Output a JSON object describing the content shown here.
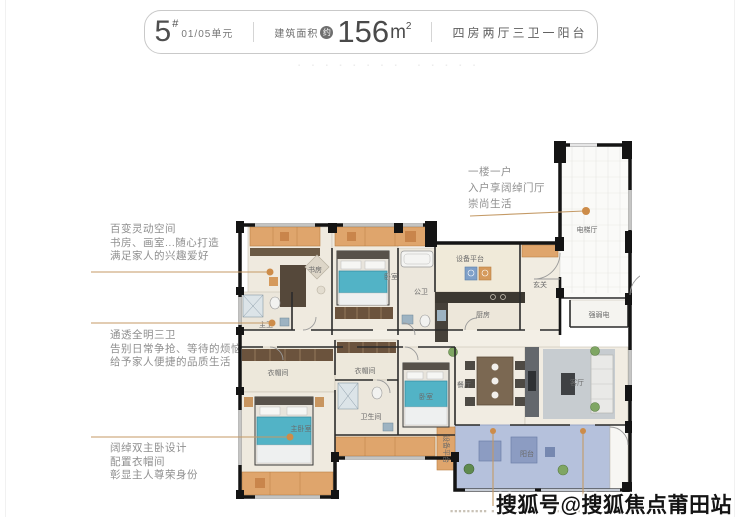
{
  "header": {
    "building_number": "5",
    "building_sup": "#",
    "unit": "01/05单元",
    "area_label": "建筑面积",
    "area_approx": "约",
    "area_value": "156",
    "area_unit": "m",
    "area_exponent": "2",
    "layout_desc": "四房两厅三卫一阳台"
  },
  "decor": {
    "faint_row_left": "▪ ▪ ▪ ▪ ▪ ▪ ▪ ▪",
    "faint_row_right": "▪ ▪ ▪ ▪ ▪",
    "bottom_fragment_left": "▪▪▪▪▪▪▪▪▪ ▪",
    "bottom_fragment_right": "▪▪▪▪▪▪▪"
  },
  "annotations": {
    "left": [
      {
        "lines": [
          "百变灵动空间",
          "书房、画室...随心打造",
          "满足家人的兴趣爱好"
        ]
      },
      {
        "lines": [
          "通透全明三卫",
          "告别日常争抢、等待的烦恼",
          "给予家人便捷的品质生活"
        ]
      },
      {
        "lines": [
          "阔绰双主卧设计",
          "配置衣帽间",
          "彰显主人尊荣身份"
        ]
      }
    ],
    "right": {
      "lines": [
        "一楼一户",
        "入户享阔绰门厅",
        "崇尚生活"
      ]
    }
  },
  "floorplan": {
    "rooms": {
      "elevator_hall": "电梯厅",
      "equipment_platform_top": "设备平台",
      "foyer": "玄关",
      "utility": "强弱电",
      "kitchen": "厨房",
      "public_bath": "公卫",
      "study": "书房",
      "bedroom_top": "卧室",
      "master_bath": "主卫",
      "closet_left": "衣帽间",
      "closet_mid": "衣帽间",
      "bathroom": "卫生间",
      "bedroom_right": "卧室",
      "master_bedroom": "主卧室",
      "dining": "餐厅",
      "living": "客厅",
      "balcony": "阳台",
      "equipment_platform_bottom": "设备平台"
    }
  },
  "watermark": {
    "text": "搜狐号@搜狐焦点莆田站"
  },
  "colors": {
    "callout_line": "#c49a66",
    "callout_dot": "#cd8c49",
    "balcony_fill": "#b5c1dc",
    "wall": "#141414",
    "floor": "#efeadf",
    "cabinet_orange": "#dfa56c",
    "bed_teal": "#52b3c6",
    "annotation_text": "#8f8f8f",
    "header_text": "#4f4f4f"
  }
}
